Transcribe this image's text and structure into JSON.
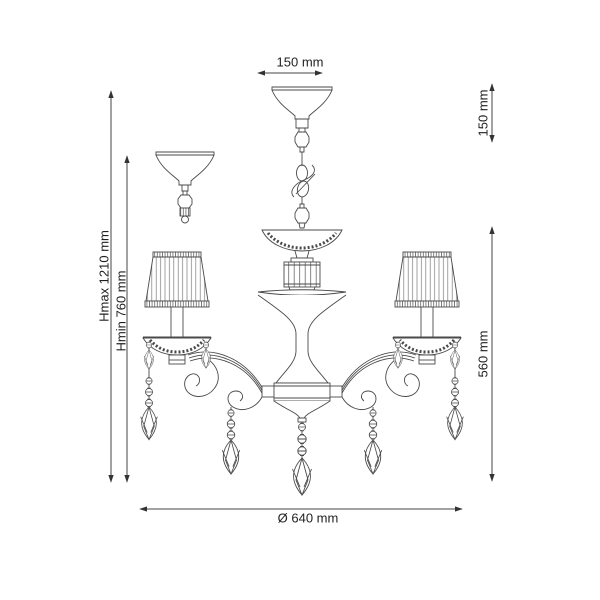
{
  "drawing": {
    "subject": "chandelier technical dimension drawing",
    "background_color": "#ffffff",
    "line_color": "#4a4a4a",
    "text_color": "#1f1f1f"
  },
  "dimensions": {
    "canopy_width": "150 mm",
    "canopy_height": "150 mm",
    "max_height": "Hmax 1210 mm",
    "min_height": "Hmin 760 mm",
    "body_height": "560 mm",
    "diameter": "Ø 640 mm"
  }
}
